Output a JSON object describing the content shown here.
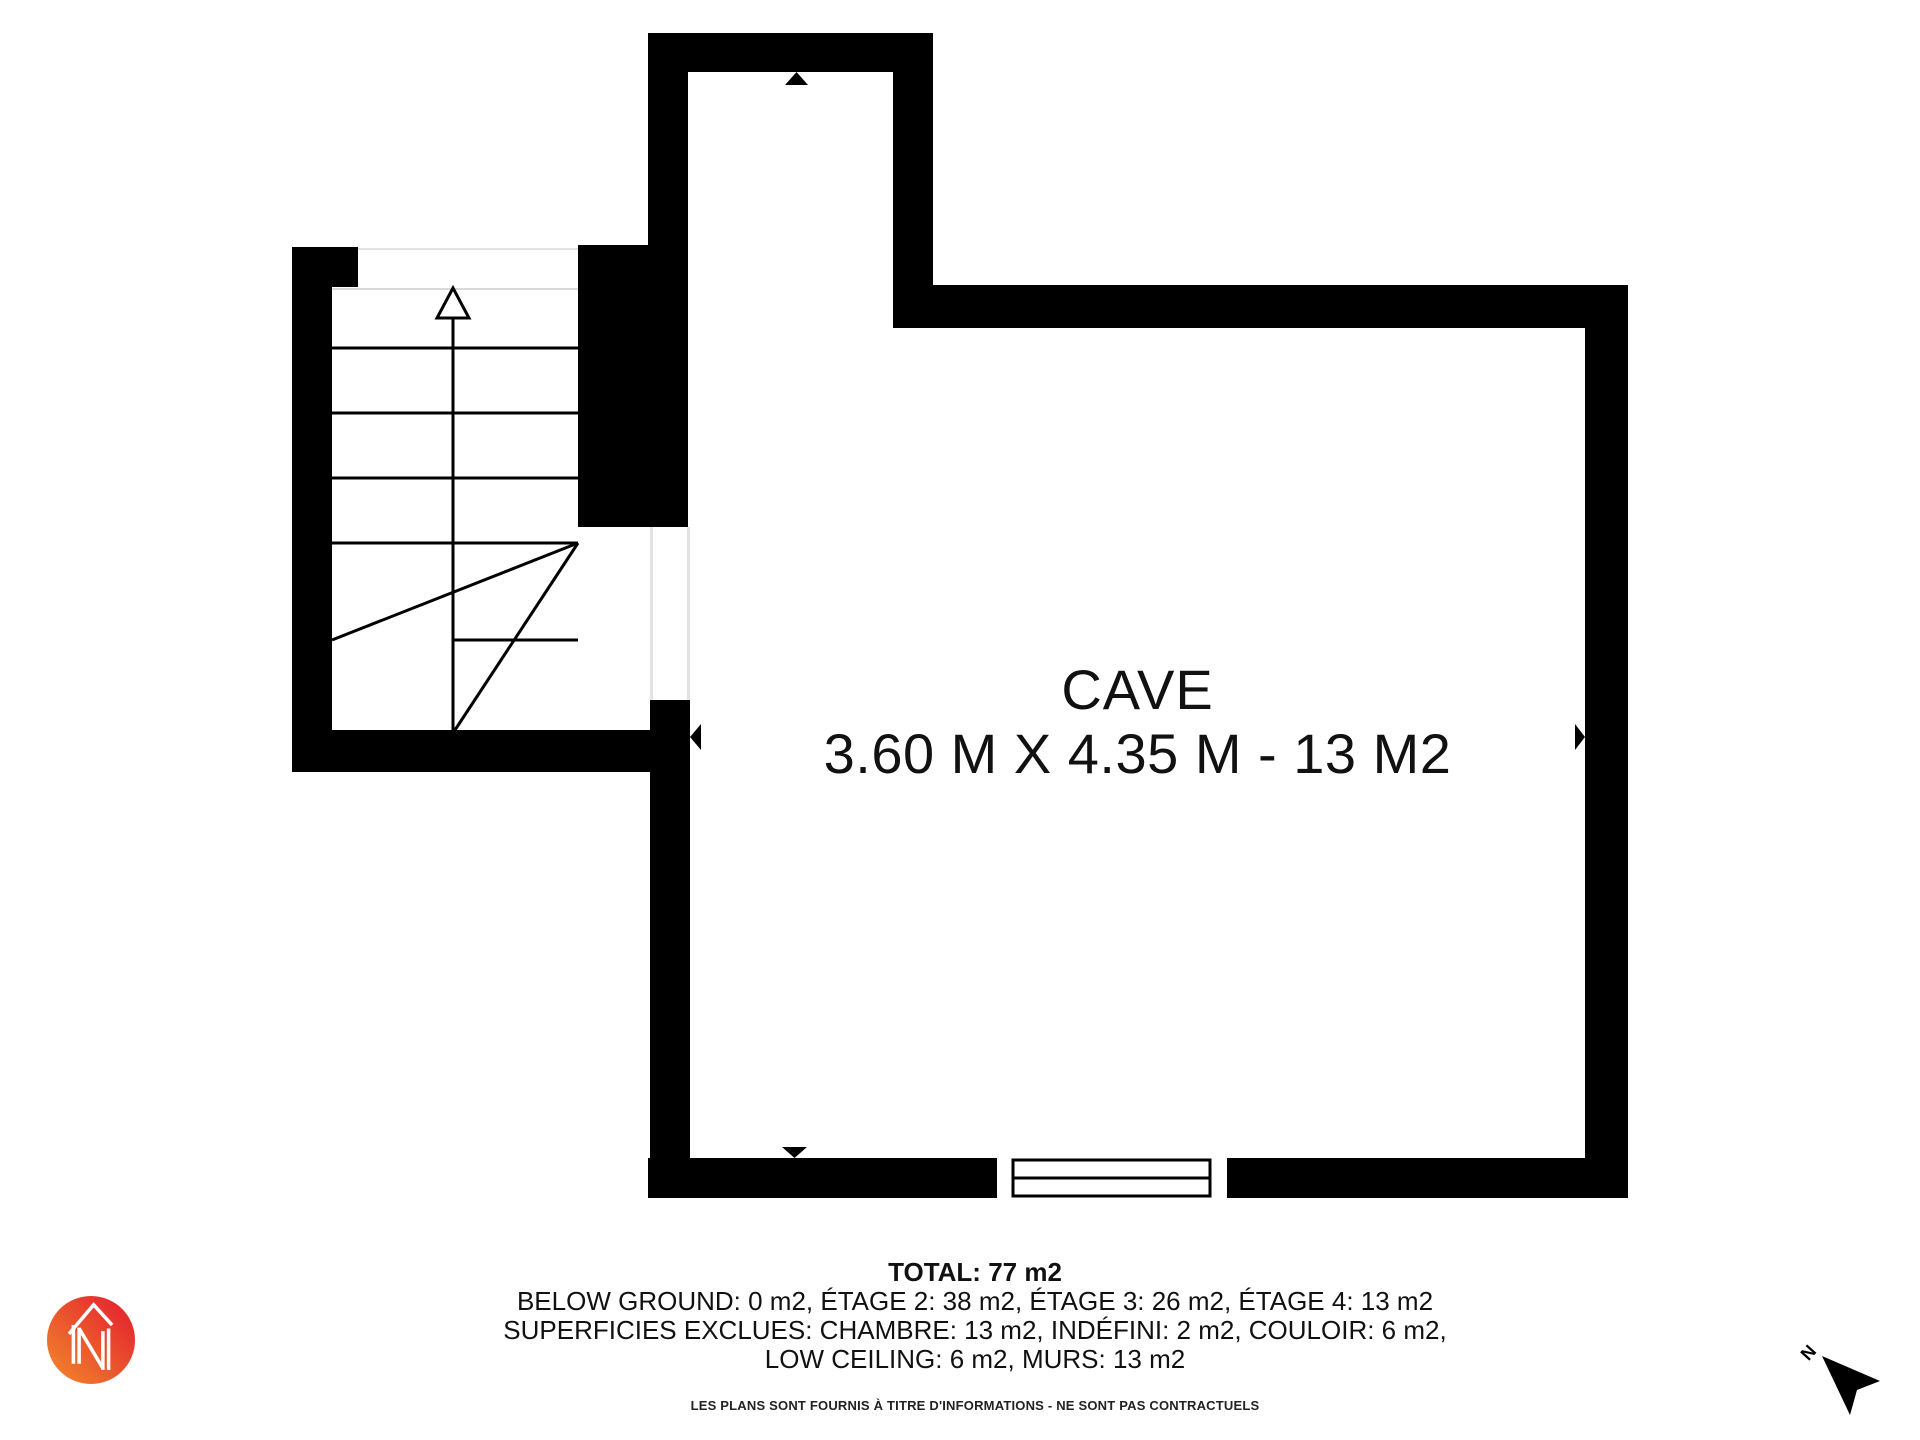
{
  "plan": {
    "room": {
      "name": "CAVE",
      "dimensions": "3.60 M X 4.35 M - 13 M2"
    }
  },
  "summary": {
    "total": "TOTAL: 77 m2",
    "floors": "BELOW GROUND: 0 m2, ÉTAGE 2: 38 m2, ÉTAGE 3: 26 m2, ÉTAGE 4: 13 m2",
    "excluded_line_1": "SUPERFICIES EXCLUES: CHAMBRE: 13 m2, INDÉFINI: 2 m2, COULOIR: 6 m2,",
    "excluded_line_2": "LOW CEILING: 6 m2, MURS: 13 m2"
  },
  "disclaimer": "LES PLANS SONT FOURNIS À TITRE D'INFORMATIONS - NE SONT PAS CONTRACTUELS",
  "compass": {
    "label": "N"
  },
  "colors": {
    "wall": "#000000",
    "background": "#ffffff",
    "stair_line": "#000000",
    "door_jamb": "#e3e3e3",
    "logo_gradient_start": "#F28B2C",
    "logo_gradient_end": "#E4252E",
    "logo_mark": "#ffffff"
  }
}
